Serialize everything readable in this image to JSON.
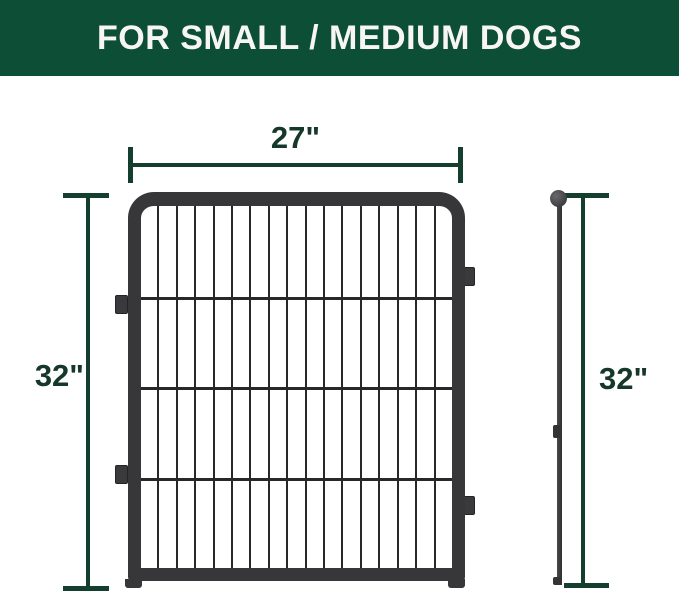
{
  "banner": {
    "title": "FOR SMALL / MEDIUM DOGS"
  },
  "dimensions": {
    "width": "27\"",
    "height_left": "32\"",
    "height_right": "32\""
  },
  "panel": {
    "vertical_bars": 16,
    "horizontal_wires": 3,
    "side_tabs_left": 2,
    "side_tabs_right": 2
  },
  "colors": {
    "background": "#ffffff",
    "banner_bg": "#0d4e37",
    "banner_text": "#f7f6f3",
    "dimension_line": "#143e2e",
    "dimension_text": "#15382a",
    "panel_frame": "#37373a",
    "panel_wire": "#28282a",
    "pole": "#3a3a3c"
  }
}
